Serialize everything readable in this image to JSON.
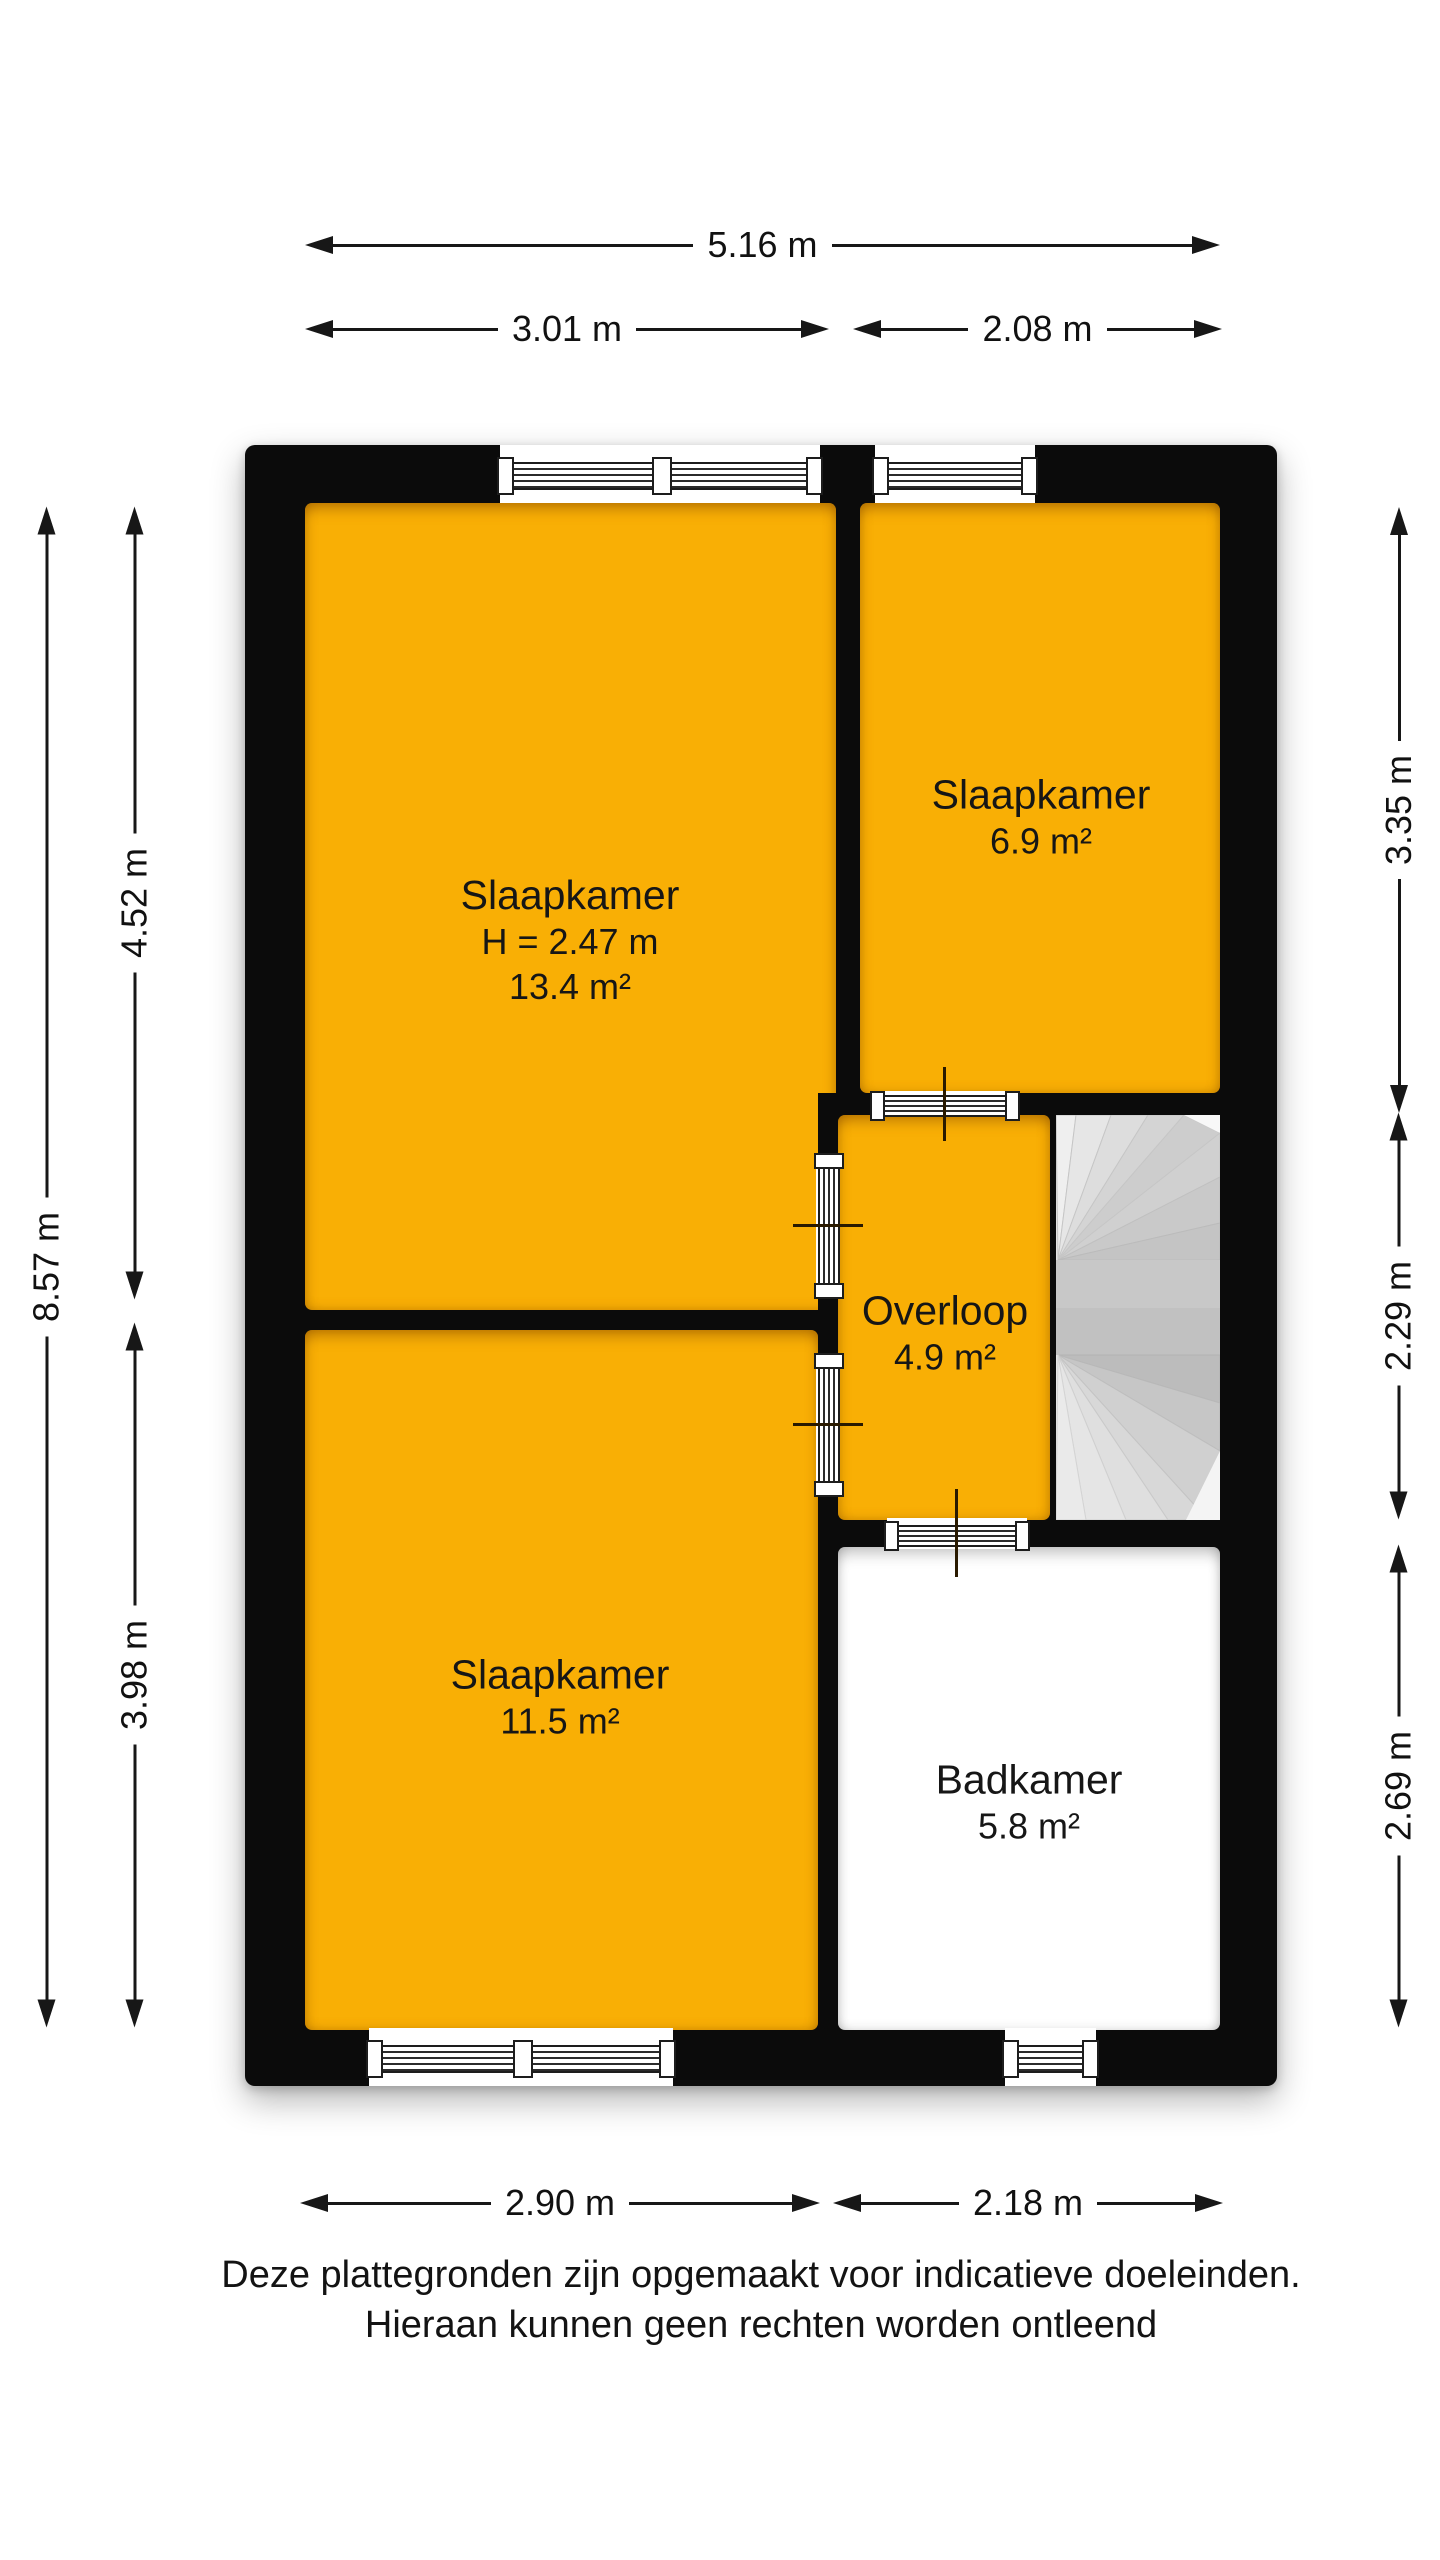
{
  "colors": {
    "room_fill": "#F9AF05",
    "wall": "#0B0B0B",
    "bathroom_fill": "#FFFFFF",
    "stairs_light": "#E6E6E6",
    "stairs_mid": "#C2C2C2"
  },
  "dims": {
    "top_total": "5.16 m",
    "top_left": "3.01 m",
    "top_right": "2.08 m",
    "left_total": "8.57 m",
    "left_upper": "4.52 m",
    "left_lower": "3.98 m",
    "right_upper": "3.35 m",
    "right_middle": "2.29 m",
    "right_lower": "2.69 m",
    "bottom_left": "2.90 m",
    "bottom_right": "2.18 m"
  },
  "rooms": {
    "bedroom_large": {
      "name": "Slaapkamer",
      "ceiling_height": "H = 2.47 m",
      "area": "13.4 m²"
    },
    "bedroom_small": {
      "name": "Slaapkamer",
      "area": "6.9 m²"
    },
    "landing": {
      "name": "Overloop",
      "area": "4.9 m²"
    },
    "bedroom_lower": {
      "name": "Slaapkamer",
      "area": "11.5 m²"
    },
    "bathroom": {
      "name": "Badkamer",
      "area": "5.8 m²"
    }
  },
  "disclaimer": {
    "line1": "Deze plattegronden zijn opgemaakt voor indicatieve doeleinden.",
    "line2": "Hieraan kunnen geen rechten worden ontleend"
  }
}
